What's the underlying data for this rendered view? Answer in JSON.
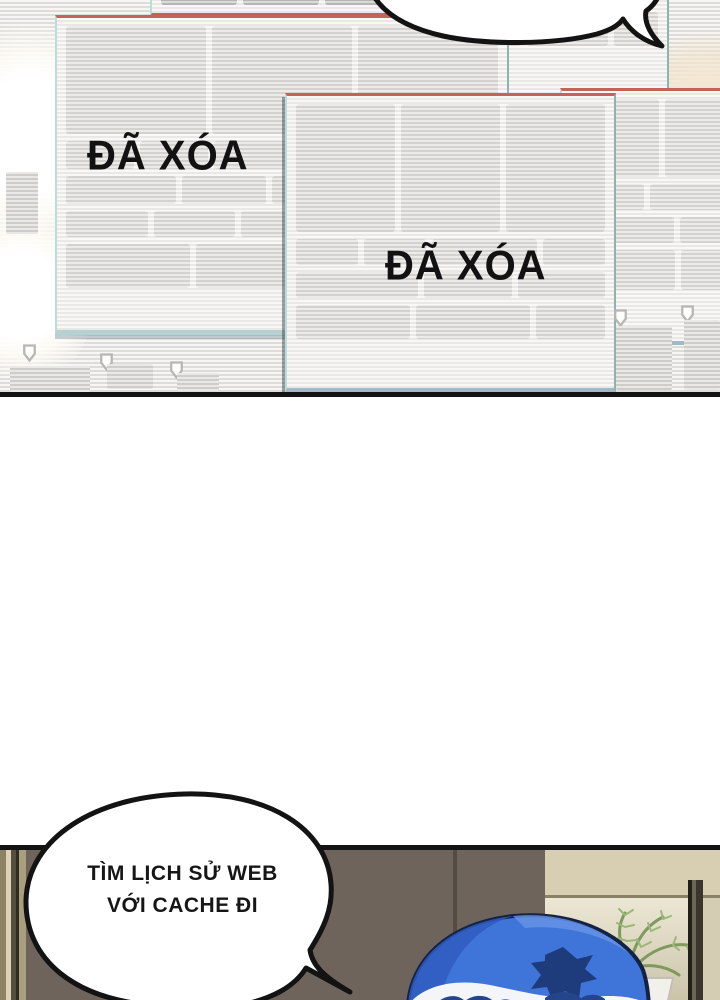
{
  "comic": {
    "panel_top": {
      "deleted_stamp_1": "ĐÃ XÓA",
      "deleted_stamp_2": "ĐÃ XÓA"
    },
    "panel_bottom": {
      "speech_line1": "TÌM LỊCH SỬ WEB",
      "speech_line2": "VỚI CACHE ĐI"
    },
    "colors": {
      "ink": "#131313",
      "scanline_gray": "#dedcd9",
      "window_block_gray": "#d5d3d0",
      "chromatic_red_edge": "#c4635a",
      "chromatic_cyan_edge": "#b9ddd8",
      "room_wall": "#6e645b",
      "window_beige": "#d8cfb2",
      "bandana_blue": "#3f74d8",
      "bandana_navy": "#1e3c7c",
      "plant_green": "#8aa465"
    }
  }
}
